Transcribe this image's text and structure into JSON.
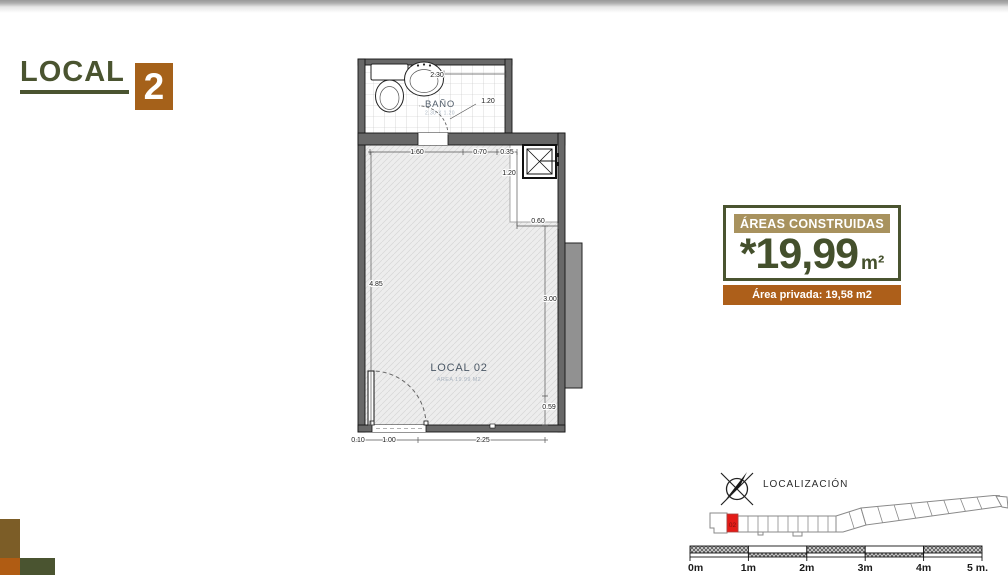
{
  "title": {
    "text": "LOCAL",
    "number": "2"
  },
  "plan": {
    "bath": {
      "label": "BAÑO",
      "dims_label": "2.30 X 1.20"
    },
    "room": {
      "label": "LOCAL 02",
      "area_label": "AREA 19.99 M2"
    },
    "dimensions": {
      "bath_width": "2.30",
      "bath_door": "1.20",
      "top_left": "1.60",
      "top_mid": "0.70",
      "top_right": "0.35",
      "shaft_height": "1.20",
      "shaft_width": "0.60",
      "left_height": "4.85",
      "right_height": "3.00",
      "right_lower": "0.59",
      "bottom_left": "0.10",
      "bottom_door": "1.00",
      "bottom_right": "2.25"
    }
  },
  "areas_box": {
    "header": "ÁREAS CONSTRUIDAS",
    "value": "*19,99",
    "unit": "m²",
    "private": "Área privada: 19,58 m2"
  },
  "localization": {
    "label": "LOCALIZACIÓN",
    "unit": "02"
  },
  "scalebar": {
    "labels": [
      "0m",
      "1m",
      "2m",
      "3m",
      "4m",
      "5 m."
    ]
  },
  "colors": {
    "green": "#4a5430",
    "brown": "#a5611a",
    "tan_header": "#a8925e",
    "orange_bar": "#ad5f1a",
    "red_unit": "#e41b17"
  }
}
